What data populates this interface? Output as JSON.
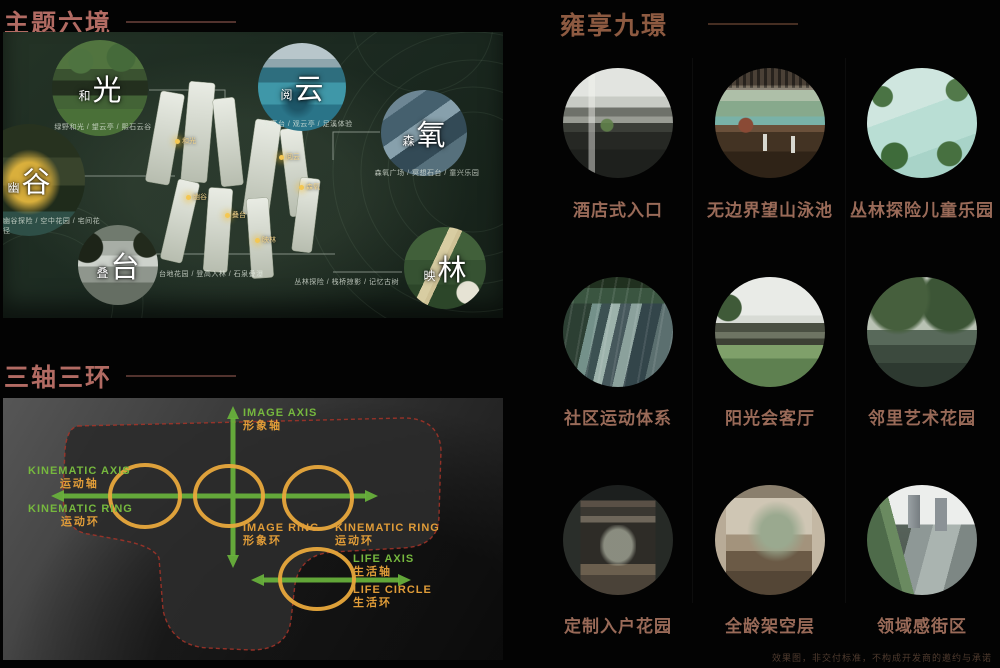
{
  "sections": {
    "six_realms": {
      "title": "主题六境",
      "realms": [
        {
          "small": "和",
          "big": "光",
          "caption": "绿野和光 / 望云亭 / 熙石云谷"
        },
        {
          "small": "阅",
          "big": "云",
          "caption": "乐水高台 / 观云亭 / 足溪体验"
        },
        {
          "small": "森",
          "big": "氧",
          "caption": "森氧广场 / 冥想石台 / 童兴乐园"
        },
        {
          "small": "幽",
          "big": "谷",
          "caption": "幽谷探险 / 空中花园 / 宅间花径"
        },
        {
          "small": "叠",
          "big": "台",
          "caption": "台地花园 / 登高入林 / 石泉叠瀑"
        },
        {
          "small": "映",
          "big": "林",
          "caption": "丛林探险 / 栈桥掠影 / 记忆古树"
        }
      ],
      "plan_markers": [
        "和光",
        "阅云",
        "森氧",
        "幽谷",
        "叠台",
        "映林"
      ]
    },
    "three_axes": {
      "title": "三轴三环",
      "labels": {
        "image_axis": {
          "en": "IMAGE AXIS",
          "cn": "形象轴"
        },
        "kinematic_axis": {
          "en": "KINEMATIC AXIS",
          "cn": "运动轴"
        },
        "kinematic_ring_left": {
          "en": "KINEMATIC RING",
          "cn": "运动环"
        },
        "image_ring": {
          "en": "IMAGE RING",
          "cn": "形象环"
        },
        "kinematic_ring_right": {
          "en": "KINEMATIC RING",
          "cn": "运动环"
        },
        "life_axis": {
          "en": "LIFE AXIS",
          "cn": "生活轴"
        },
        "life_circle": {
          "en": "LIFE CIRCLE",
          "cn": "生活环"
        }
      }
    },
    "nine_scenes": {
      "title": "雍享九璟",
      "items": [
        {
          "label": "酒店式入口"
        },
        {
          "label": "无边界望山泳池"
        },
        {
          "label": "丛林探险儿童乐园"
        },
        {
          "label": "社区运动体系"
        },
        {
          "label": "阳光会客厅"
        },
        {
          "label": "邻里艺术花园"
        },
        {
          "label": "定制入户花园"
        },
        {
          "label": "全龄架空层"
        },
        {
          "label": "领域感街区"
        }
      ]
    }
  },
  "footer": {
    "disclaimer": "效果图，非交付标准，不构成开发商的邀约与承诺"
  },
  "colors": {
    "axis_green": "#76b83e",
    "ring_orange": "#e8a83c",
    "boundary_red": "#a83428",
    "title_rose": "#b26b63",
    "title_brown": "#8d5a41",
    "caption_brown": "#996a58"
  }
}
